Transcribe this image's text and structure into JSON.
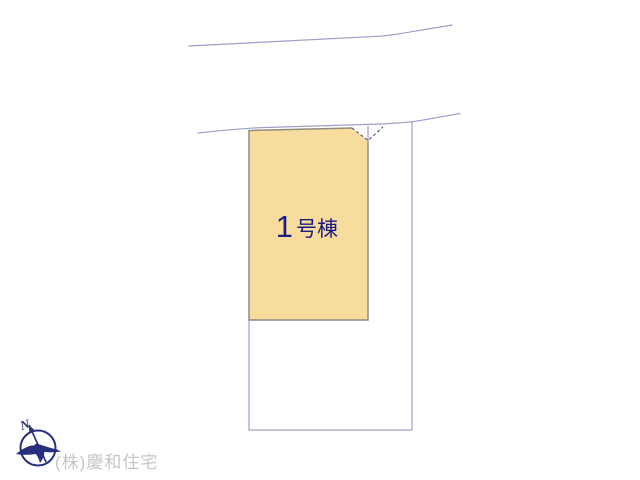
{
  "diagram": {
    "building": {
      "label": "1号棟",
      "label_number": "1",
      "label_suffix": "号棟"
    },
    "compass": {
      "north_label": "N"
    },
    "watermark": {
      "company": "(株)慶和住宅"
    },
    "colors": {
      "background": "#FFFFFF",
      "boundary_line": "#9B9FC8",
      "building_fill": "#F8DC9E",
      "building_border": "#8E8B7C",
      "corner_dash": "#5C5C8E",
      "label_text": "#1B1B83",
      "compass_navy": "#28307E",
      "watermark_text": "#C6C6C6"
    }
  }
}
